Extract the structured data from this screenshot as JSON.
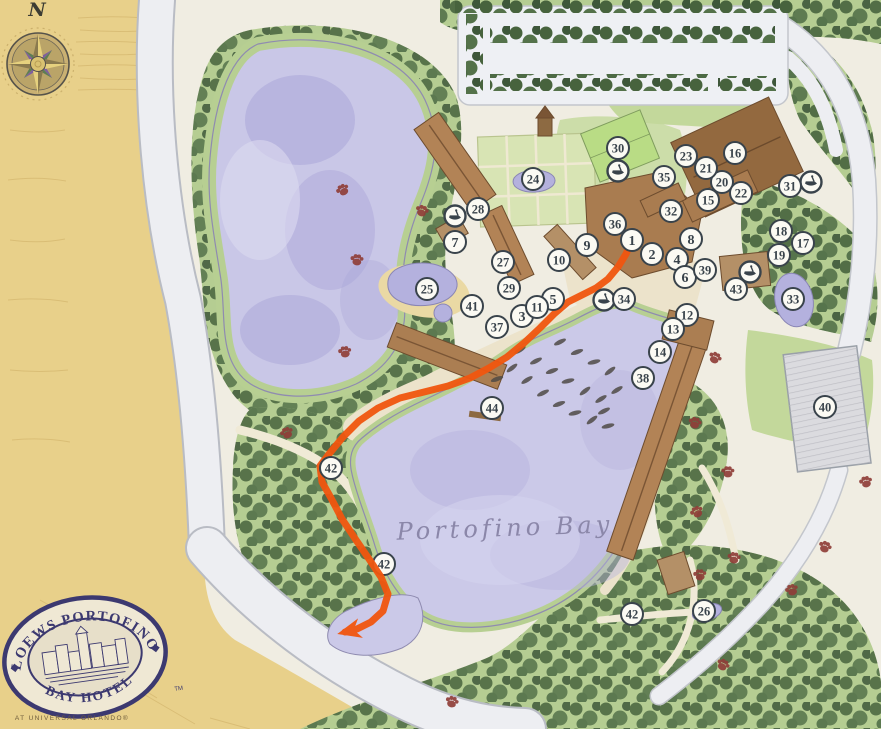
{
  "map": {
    "bay_label": "Portofino Bay",
    "north_label": "N",
    "colors": {
      "route": "#f1560f",
      "marker_border": "#39434b",
      "marker_fill": "#fbfaf3",
      "water": "#c9c7e7",
      "parchment": "#e8d08a",
      "paw": "#8f3e38"
    },
    "markers": [
      {
        "n": "1",
        "x": 632,
        "y": 240
      },
      {
        "n": "2",
        "x": 652,
        "y": 254
      },
      {
        "n": "3",
        "x": 522,
        "y": 316
      },
      {
        "n": "4",
        "x": 677,
        "y": 259
      },
      {
        "n": "5",
        "x": 553,
        "y": 299
      },
      {
        "n": "6",
        "x": 685,
        "y": 277
      },
      {
        "n": "7",
        "x": 455,
        "y": 242
      },
      {
        "n": "8",
        "x": 691,
        "y": 239
      },
      {
        "n": "9",
        "x": 587,
        "y": 245
      },
      {
        "n": "10",
        "x": 559,
        "y": 260
      },
      {
        "n": "11",
        "x": 537,
        "y": 307
      },
      {
        "n": "12",
        "x": 687,
        "y": 315
      },
      {
        "n": "13",
        "x": 673,
        "y": 329
      },
      {
        "n": "14",
        "x": 660,
        "y": 352
      },
      {
        "n": "15",
        "x": 708,
        "y": 200
      },
      {
        "n": "16",
        "x": 735,
        "y": 153
      },
      {
        "n": "17",
        "x": 803,
        "y": 243
      },
      {
        "n": "18",
        "x": 781,
        "y": 231
      },
      {
        "n": "19",
        "x": 779,
        "y": 255
      },
      {
        "n": "20",
        "x": 722,
        "y": 182
      },
      {
        "n": "21",
        "x": 706,
        "y": 168
      },
      {
        "n": "22",
        "x": 741,
        "y": 193
      },
      {
        "n": "23",
        "x": 686,
        "y": 156
      },
      {
        "n": "24",
        "x": 533,
        "y": 179
      },
      {
        "n": "25",
        "x": 427,
        "y": 289
      },
      {
        "n": "26",
        "x": 704,
        "y": 611
      },
      {
        "n": "27",
        "x": 503,
        "y": 262
      },
      {
        "n": "28",
        "x": 478,
        "y": 209
      },
      {
        "n": "29",
        "x": 509,
        "y": 288
      },
      {
        "n": "30",
        "x": 618,
        "y": 148
      },
      {
        "n": "31",
        "x": 790,
        "y": 186
      },
      {
        "n": "32",
        "x": 671,
        "y": 211
      },
      {
        "n": "33",
        "x": 793,
        "y": 299
      },
      {
        "n": "34",
        "x": 624,
        "y": 299
      },
      {
        "n": "35",
        "x": 664,
        "y": 177
      },
      {
        "n": "36",
        "x": 615,
        "y": 224
      },
      {
        "n": "37",
        "x": 497,
        "y": 327
      },
      {
        "n": "38",
        "x": 643,
        "y": 378
      },
      {
        "n": "39",
        "x": 705,
        "y": 270
      },
      {
        "n": "40",
        "x": 825,
        "y": 407
      },
      {
        "n": "41",
        "x": 472,
        "y": 306
      },
      {
        "n": "42",
        "x": 331,
        "y": 468
      },
      {
        "n": "42",
        "x": 384,
        "y": 564,
        "under": true
      },
      {
        "n": "42",
        "x": 632,
        "y": 614
      },
      {
        "n": "43",
        "x": 736,
        "y": 289
      },
      {
        "n": "44",
        "x": 492,
        "y": 408
      }
    ],
    "boat_stops": [
      {
        "x": 455,
        "y": 216
      },
      {
        "x": 618,
        "y": 171
      },
      {
        "x": 604,
        "y": 300
      },
      {
        "x": 811,
        "y": 182
      },
      {
        "x": 750,
        "y": 272
      }
    ],
    "paw_prints": [
      {
        "x": 343,
        "y": 190
      },
      {
        "x": 422,
        "y": 211
      },
      {
        "x": 357,
        "y": 260
      },
      {
        "x": 345,
        "y": 352
      },
      {
        "x": 287,
        "y": 433
      },
      {
        "x": 715,
        "y": 358
      },
      {
        "x": 695,
        "y": 423
      },
      {
        "x": 728,
        "y": 472
      },
      {
        "x": 866,
        "y": 482
      },
      {
        "x": 697,
        "y": 512
      },
      {
        "x": 825,
        "y": 547
      },
      {
        "x": 734,
        "y": 558
      },
      {
        "x": 700,
        "y": 575
      },
      {
        "x": 792,
        "y": 590
      },
      {
        "x": 723,
        "y": 665
      },
      {
        "x": 452,
        "y": 702
      }
    ],
    "boats": [
      [
        512,
        368
      ],
      [
        527,
        380
      ],
      [
        543,
        393
      ],
      [
        559,
        404
      ],
      [
        575,
        413
      ],
      [
        592,
        420
      ],
      [
        520,
        350
      ],
      [
        536,
        361
      ],
      [
        552,
        371
      ],
      [
        568,
        381
      ],
      [
        585,
        391
      ],
      [
        601,
        399
      ],
      [
        560,
        342
      ],
      [
        577,
        352
      ],
      [
        594,
        362
      ],
      [
        610,
        371
      ],
      [
        617,
        390
      ],
      [
        604,
        411
      ],
      [
        497,
        379
      ],
      [
        608,
        426
      ]
    ],
    "route": {
      "color": "#f1560f",
      "points": [
        [
          631,
          243
        ],
        [
          626,
          254
        ],
        [
          618,
          267
        ],
        [
          608,
          279
        ],
        [
          596,
          288
        ],
        [
          582,
          295
        ],
        [
          568,
          302
        ],
        [
          554,
          314
        ],
        [
          540,
          328
        ],
        [
          524,
          343
        ],
        [
          507,
          357
        ],
        [
          489,
          368
        ],
        [
          470,
          378
        ],
        [
          448,
          386
        ],
        [
          424,
          392
        ],
        [
          400,
          398
        ],
        [
          378,
          408
        ],
        [
          359,
          421
        ],
        [
          343,
          437
        ],
        [
          329,
          454
        ],
        [
          320,
          466
        ],
        [
          322,
          482
        ],
        [
          331,
          498
        ],
        [
          342,
          519
        ],
        [
          356,
          540
        ],
        [
          369,
          559
        ],
        [
          381,
          577
        ],
        [
          388,
          594
        ],
        [
          383,
          611
        ],
        [
          371,
          622
        ],
        [
          357,
          629
        ],
        [
          345,
          632
        ]
      ]
    }
  },
  "logo": {
    "line1": "LOEWS PORTOFINO",
    "line2": "BAY HOTEL",
    "tm": "TM",
    "subtext": "AT UNIVERSAL ORLANDO®"
  }
}
